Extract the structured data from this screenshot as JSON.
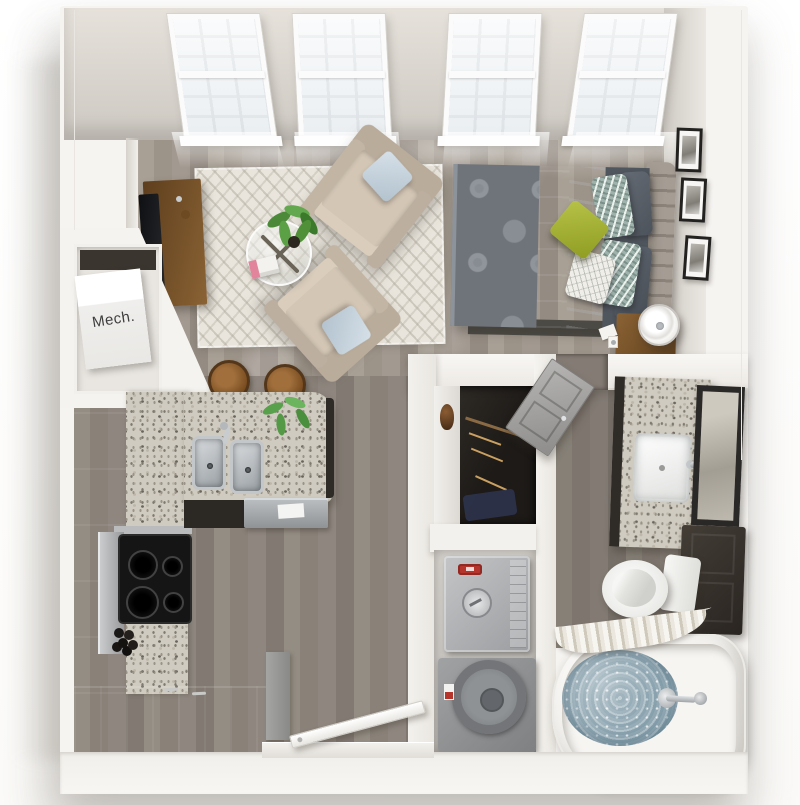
{
  "scene": {
    "type": "3d-floor-plan-render",
    "description": "Top-down 3D rendering of a studio apartment floor plan with white walls and gray wood floors",
    "view": "bird's-eye perspective, slightly tilted"
  },
  "labels": {
    "mech_closet": "Mech."
  },
  "counts": {
    "windows": 4,
    "wall_art_frames": 3,
    "armchairs": 2,
    "bar_stools": 2,
    "bed_pillows": 6
  },
  "rooms": [
    {
      "name": "living-sleeping-area",
      "items": [
        "four tall divided-light windows",
        "chevron area rug",
        "two beige armchairs with light blue pillows",
        "round glass coffee table with X base",
        "books",
        "potted houseplant",
        "wood tv console with tv",
        "queen bed with patterned gray duvet",
        "white flat sheet",
        "green accent pillow",
        "gray and ikat pillows",
        "channel-tufted headboard",
        "three framed wall art pieces",
        "wood nightstand",
        "white drum table lamp",
        "wall hook"
      ]
    },
    {
      "name": "kitchen",
      "items": [
        "espresso cabinet run",
        "granite counters",
        "stainless range and black cooktop with four burners",
        "granite island with double stainless sink and faucet",
        "stainless dishwasher with towel",
        "two round wood bar stools",
        "small green plant",
        "bowl of dark decorative spheres",
        "dark breakfast counter",
        "gray end cabinet panel"
      ]
    },
    {
      "name": "entry",
      "items": [
        "open white entry door",
        "threshold"
      ]
    },
    {
      "name": "mech-closet",
      "items": [
        "white mechanical unit labeled Mech."
      ]
    },
    {
      "name": "walk-in-closet",
      "items": [
        "white shelf",
        "brown vase",
        "hanging rod with wood hangers",
        "navy storage bin"
      ]
    },
    {
      "name": "laundry-closet",
      "items": [
        "gray top-load washer with dial and red button",
        "gray dryer with round door"
      ]
    },
    {
      "name": "bathroom",
      "items": [
        "gray two-panel door",
        "granite vanity with white rectangular sink and chrome faucet",
        "dark-framed mirror",
        "espresso linen cabinet",
        "white toilet with tank",
        "white soaking tub filled with water",
        "chrome tub faucet and handle",
        "pleated shower curtain on curved rod"
      ]
    }
  ],
  "palette": {
    "background": "#ffffff",
    "exterior_wall": "#f6f4f1",
    "interior_wall_face": "#d6d2cb",
    "wood_floor_living": "#a39a91",
    "wood_floor_kitchen": "#8b8279",
    "wood_floor_bath": "#7d756d",
    "rug": "#e9e5dc",
    "armchair": "#d3c6b5",
    "accent_pillow_blue": "#c5d3de",
    "duvet_gray": "#6f737a",
    "accent_pillow_green": "#a3b232",
    "headboard_taupe": "#a59d94",
    "espresso_cabinet": "#3a3531",
    "granite_counter": "#d0cbc0",
    "stainless_steel": "#b0b4b6",
    "cooktop_black": "#151515",
    "washer_gray": "#b0b2b4",
    "dryer_gray": "#8e9092",
    "tub_water_blue": "#92a9b4",
    "bath_door_gray": "#a2a19f",
    "wood_furniture_brown": "#7a5732",
    "mech_label_text": "#3e3e3e"
  }
}
